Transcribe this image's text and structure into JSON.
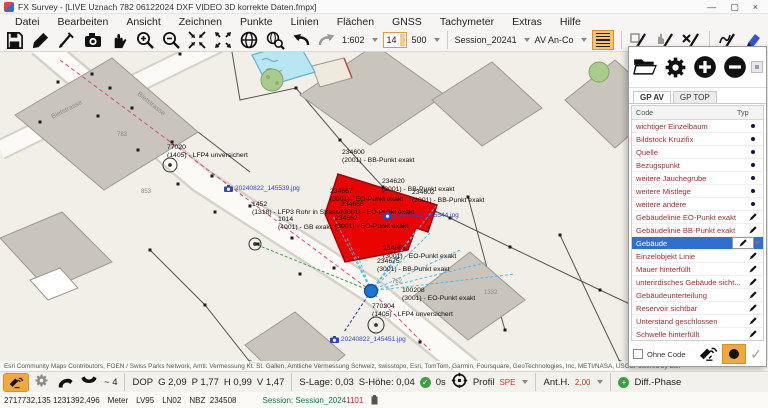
{
  "window": {
    "title": "FX Survey - [LIVE Uznach 782 06122024 DXF VIDEO 3D korrekte Daten.fmpx]",
    "minimize": "—",
    "maximize": "▢",
    "close": "×"
  },
  "menu": {
    "items": [
      {
        "label": "Datei"
      },
      {
        "label": "Bearbeiten"
      },
      {
        "label": "Ansicht"
      },
      {
        "label": "Zeichnen"
      },
      {
        "label": "Punkte"
      },
      {
        "label": "Linien"
      },
      {
        "label": "Flächen"
      },
      {
        "label": "GNSS"
      },
      {
        "label": "Tachymeter"
      },
      {
        "label": "Extras"
      },
      {
        "label": "Hilfe"
      }
    ]
  },
  "toolbar": {
    "scale": "1:602",
    "spinner_value": "14",
    "snap_value": "500",
    "session_value": "Session_20241",
    "code_list_value": "AV An-Co"
  },
  "panel": {
    "tabs": [
      {
        "label": "GP AV",
        "selected": true
      },
      {
        "label": "GP TOP"
      }
    ],
    "header": {
      "code": "Code",
      "typ": "Typ"
    },
    "rows": [
      {
        "label": "wichtiger Einzelbaum",
        "typ": "point"
      },
      {
        "label": "Bildstock Kruzifix",
        "typ": "point"
      },
      {
        "label": "Quelle",
        "typ": "point"
      },
      {
        "label": "Bezugspunkt",
        "typ": "point"
      },
      {
        "label": "weitere Jauchegrube",
        "typ": "point"
      },
      {
        "label": "weitere Mistlege",
        "typ": "point"
      },
      {
        "label": "weitere andere",
        "typ": "point"
      },
      {
        "label": "Gebäudelinie EO-Punkt exakt",
        "typ": "line"
      },
      {
        "label": "Gebäudelinie BB-Punkt exakt",
        "typ": "line"
      },
      {
        "label": "Gebäude",
        "typ": "line",
        "selected": true
      },
      {
        "label": "Einzelobjekt Linie",
        "typ": "line"
      },
      {
        "label": "Mauer hinterfüllt",
        "typ": "line"
      },
      {
        "label": "unterirdisches Gebäude sicht...",
        "typ": "line"
      },
      {
        "label": "Gebäudeunterteilung",
        "typ": "line"
      },
      {
        "label": "Reservoir sichtbar",
        "typ": "line"
      },
      {
        "label": "Unterstand geschlossen",
        "typ": "line"
      },
      {
        "label": "Schwelle hinterfüllt",
        "typ": "line"
      },
      {
        "label": "Ruine unterirdisch",
        "typ": "line"
      },
      {
        "label": "Druckleitung oberirdisch",
        "typ": "line"
      }
    ],
    "footer": {
      "ohne_code": "Ohne Code"
    }
  },
  "map": {
    "points": [
      {
        "id": "77020",
        "desc": "(1405) - LFP4 unversichert",
        "x": 167,
        "y": 92
      },
      {
        "id": "1452",
        "desc": "(1318) - LFP3 Rohr in Strasse",
        "x": 252,
        "y": 149
      },
      {
        "id": "1014",
        "desc": "(4001) - GB exakt",
        "x": 278,
        "y": 164
      },
      {
        "id": "234600",
        "desc": "(2001) - BB-Punkt exakt",
        "x": 342,
        "y": 97
      },
      {
        "id": "234620",
        "desc": "(2001) - BB-Punkt exakt",
        "x": 382,
        "y": 126
      },
      {
        "id": "234602",
        "desc": "(2001) - BB-Punkt exakt",
        "x": 412,
        "y": 137
      },
      {
        "id": "234667",
        "desc": "(3001) - EO-Punkt exakt",
        "x": 330,
        "y": 136
      },
      {
        "id": "234666",
        "desc": "(3001) - EO-Punkt exakt",
        "x": 341,
        "y": 149
      },
      {
        "id": "234662",
        "desc": "(3001) - EO-Punkt exakt",
        "x": 335,
        "y": 163
      },
      {
        "id": "234663",
        "desc": "(3001) - EO-Punkt exakt",
        "x": 383,
        "y": 193
      },
      {
        "id": "234675",
        "desc": "(3001) - BB-Punkt exakt",
        "x": 377,
        "y": 206
      },
      {
        "id": "100208",
        "desc": "(3001) - EO-Punkt exakt",
        "x": 402,
        "y": 235
      },
      {
        "id": "770204",
        "desc": "(1405) - LFP4 unversichert",
        "x": 372,
        "y": 251
      }
    ],
    "photos": [
      {
        "name": "20240822_145539.jpg",
        "x": 224,
        "y": 133
      },
      {
        "name": "20240822_145544.jpg",
        "x": 383,
        "y": 160
      },
      {
        "name": "20240822_145451.jpg",
        "x": 330,
        "y": 284
      }
    ],
    "bldg_labels": [
      {
        "text": "783",
        "x": 117,
        "y": 80
      },
      {
        "text": "853",
        "x": 141,
        "y": 137
      },
      {
        "text": "762",
        "x": 392,
        "y": 227
      },
      {
        "text": "1332",
        "x": 484,
        "y": 238
      }
    ],
    "street_labels": [
      {
        "name": "Bietstrasse",
        "x": 52,
        "y": 62,
        "rot": -27
      },
      {
        "name": "Bietstrasse",
        "x": 138,
        "y": 38,
        "rot": 39
      }
    ]
  },
  "attribution": {
    "text": "Esri Community Maps Contributors, FOEN / Swiss Parks Network, Amtl. Vermessung Kt. St. Gallen, Amtliche Vermessung Schweiz, swisstopo, Esri, TomTom, Garmin, Foursquare, GeoTechnologies, Inc, METI/NASA, USGS",
    "powered": "Powered by Esri"
  },
  "statusbar": {
    "sat_count": "4",
    "dop_label": "DOP",
    "g": "G  2,09",
    "p": "P  1,77",
    "h": "H  0,99",
    "v": "V  1,47",
    "s_lage": "S-Lage:  0,03",
    "s_hoehe": "S-Höhe:  0,04",
    "age": "0s",
    "profil_label": "Profil",
    "profil_value": "SPE",
    "ant_label": "Ant.H.",
    "ant_value": "2,00",
    "diff_plus": "+",
    "diff": "Diff.-Phase",
    "check": "✓"
  },
  "coordbar": {
    "coords": "2717732,135  1231392,496",
    "unit": "Meter",
    "frame": "LV95",
    "height_sys": "LN02",
    "nbz_label": "NBZ",
    "nbz_value": "234508",
    "session_label": "Session:",
    "session_value": "Session_2024",
    "session_highlight": "1101"
  }
}
